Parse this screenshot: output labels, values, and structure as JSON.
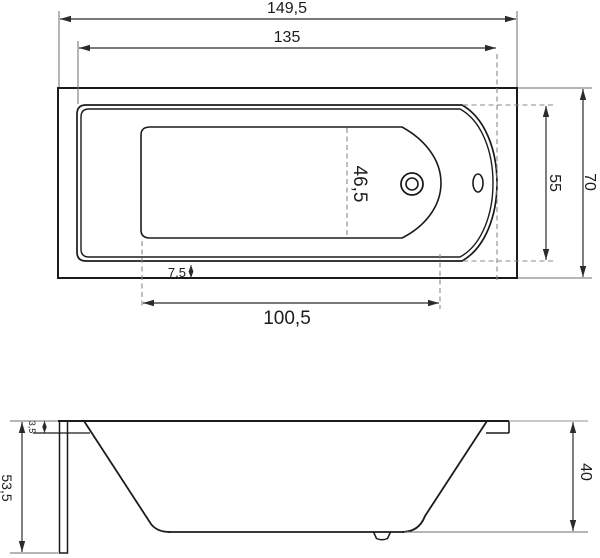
{
  "colors": {
    "line": "#1b1b1b",
    "dim": "#2b2b2b",
    "extension": "#6e6e6e",
    "light_extension": "#a9a9a9",
    "dashed": "#8a8a8a",
    "text": "#1c1c1c",
    "background": "#ffffff"
  },
  "top_view": {
    "dim_overall_length": "149,5",
    "dim_rim_length": "135",
    "dim_basin_length": "100,5",
    "dim_rim_to_edge": "7,5",
    "dim_center_width": "46,5",
    "dim_rim_width": "55",
    "dim_overall_width": "70"
  },
  "side_view": {
    "dim_total_height": "53,5",
    "dim_rim_height": "3,5",
    "dim_body_height": "40"
  }
}
